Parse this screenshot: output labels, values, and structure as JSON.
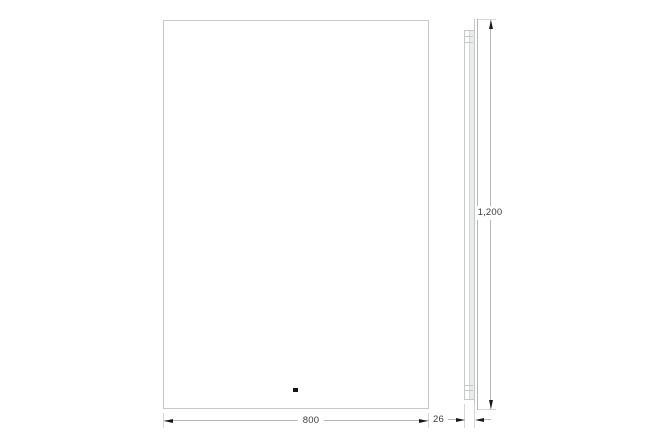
{
  "drawing": {
    "kind": "mirror-dimension-diagram",
    "views": {
      "front": {
        "width_label": "800",
        "sensor_dot": true
      },
      "side": {
        "height_label": "1,200",
        "depth_label": "26"
      }
    },
    "colors": {
      "background": "#ffffff",
      "line": "#c6c8c8",
      "line_inner": "#d6d8d8",
      "dim_line": "#b5b7b7",
      "arrow": "#1a1a1a",
      "text": "#3c3c3c",
      "sensor_dot": "#151515",
      "panel_fill": "#eaebeb"
    }
  }
}
